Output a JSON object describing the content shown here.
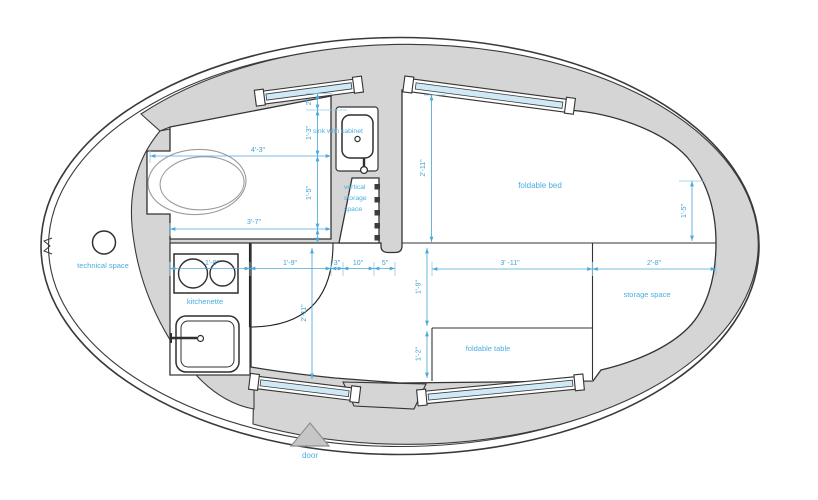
{
  "colors": {
    "wall_fill": "#d5d5d5",
    "outline": "#3a3a3a",
    "window_glass": "#cfe9f7",
    "dimension_blue": "#3fa3d6",
    "label_blue": "#4aaede",
    "door_marker_fill": "#c6c6c6"
  },
  "rooms": {
    "technical_space": "technical space",
    "sink_cabinet": "sink with cabinet",
    "vertical_storage": [
      "vertical",
      "storage",
      "space"
    ],
    "foldable_bed": "foldable bed",
    "kitchenette": "kitchenette",
    "storage_space": "storage space",
    "foldable_table": "foldable table",
    "door": "door"
  },
  "dimensions": {
    "top_small": "2\"",
    "sink_depth": "1'-3\"",
    "bath_mid": "1'-5\"",
    "bath_width_top": "4'-3\"",
    "bath_width_bottom": "3'-7\"",
    "bed_depth": "2'-11\"",
    "bed_side": "1'-5\"",
    "kitchen_width": "1'-8\"",
    "door_width": "1'-9\"",
    "gap_3": "3\"",
    "gap_10": "10\"",
    "gap_5": "5\"",
    "table_width": "3' -11\"",
    "storage_width": "2'-8\"",
    "table_offset": "1'-9\"",
    "table_depth": "1'-2\"",
    "room_depth": "2'-11\""
  }
}
